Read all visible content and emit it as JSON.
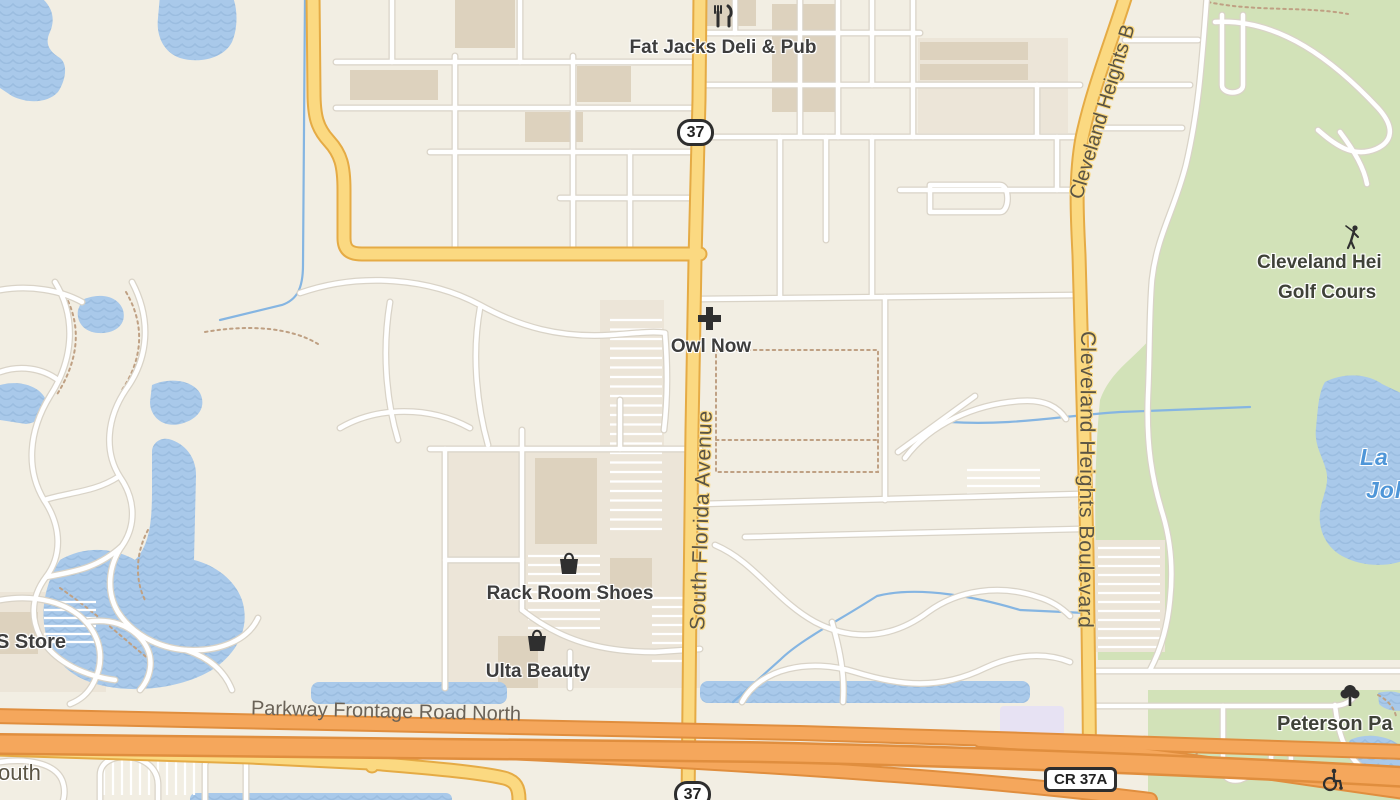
{
  "colors": {
    "background": "#f2eee3",
    "road_casing": "#d9d3c7",
    "road_fill": "#ffffff",
    "yellow_road": "#fbd981",
    "yellow_casing": "#e5ab45",
    "orange_road": "#f5a75c",
    "orange_casing": "#e08e3e",
    "water": "#a9c9ea",
    "water_wave": "#9bbde0",
    "stream": "#85b5e2",
    "park_green": "#d2e2b8",
    "label_dark": "#3d3d3d",
    "label_street": "#5a5444",
    "label_water": "#4f96d8",
    "icon_dark": "#2f2f2f",
    "shield_border": "#2e2e2e",
    "plaza_tint": "#ece5d8",
    "building": "#ddd2be",
    "lavender": "#e7e2f3",
    "trail": "#bfa083"
  },
  "labels": {
    "pois": {
      "fat_jacks": "Fat Jacks Deli & Pub",
      "owl_now": "Owl Now",
      "rack_room_shoes": "Rack Room Shoes",
      "ulta_beauty": "Ulta Beauty",
      "s_store": "S Store"
    },
    "streets": {
      "south_florida_avenue": "South Florida Avenue",
      "cleveland_heights_boulevard": "Cleveland Heights Boulevard",
      "cleveland_heights_partial": "Cleveland Heights B",
      "parkway_frontage_road_north": "Parkway Frontage Road North",
      "frontage_south_partial": "outh"
    },
    "areas": {
      "golf_line1": "Cleveland Hei",
      "golf_line2": "Golf Cours",
      "peterson_park_partial": "Peterson Pa"
    },
    "water": {
      "lake_line1": "La",
      "lake_line2": "Joh"
    }
  },
  "shields": {
    "route_37_north": "37",
    "route_37_south": "37",
    "cr_37a": "CR 37A"
  },
  "icons": {
    "restaurant": "fork-knife-icon",
    "medical": "cross-icon",
    "shopping": "bag-icon",
    "golf": "golfer-icon",
    "park": "tree-icon",
    "accessible": "wheelchair-icon"
  }
}
